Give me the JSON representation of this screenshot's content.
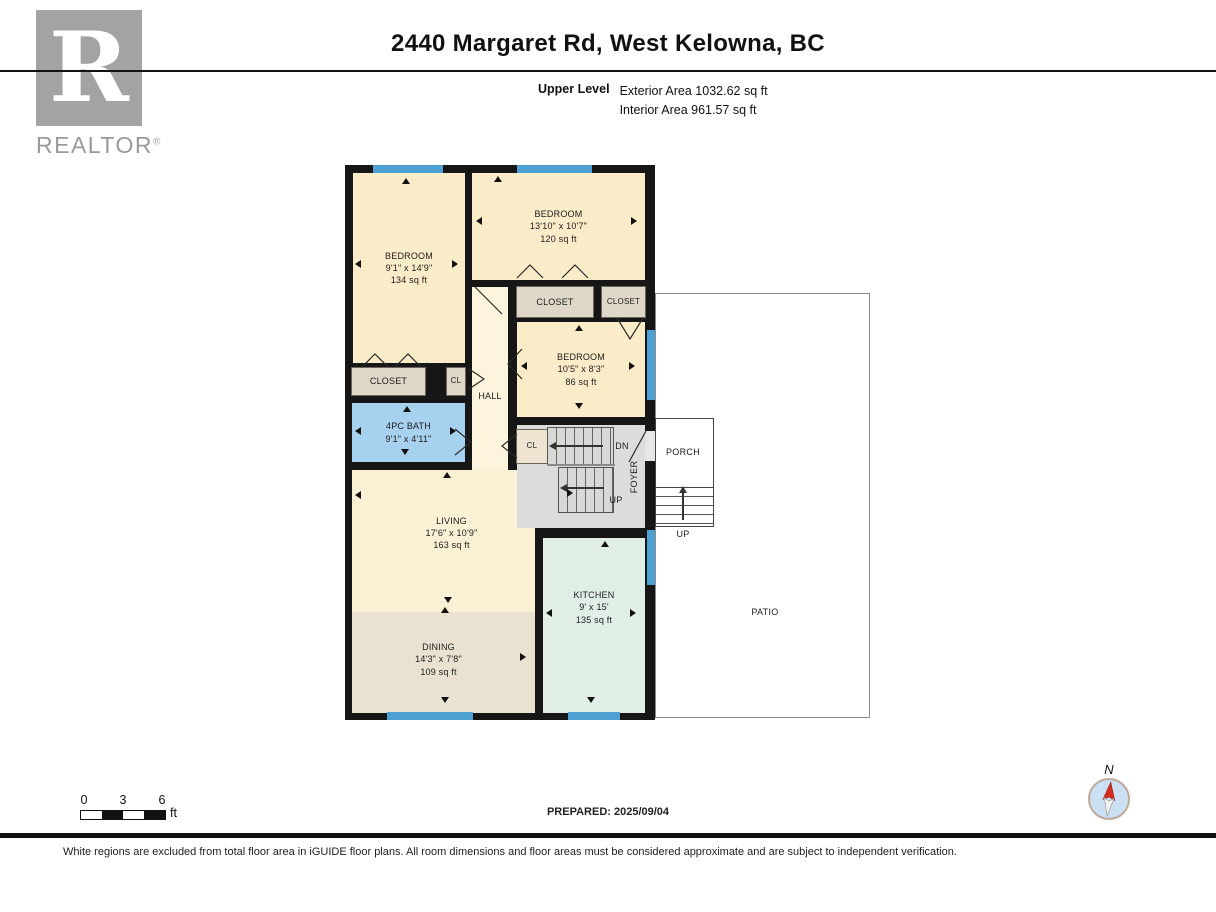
{
  "header": {
    "title": "2440 Margaret Rd, West Kelowna, BC",
    "level_label": "Upper Level",
    "exterior_area": "Exterior Area 1032.62 sq ft",
    "interior_area": "Interior Area 961.57 sq ft"
  },
  "logo": {
    "letter": "R",
    "brand": "REALTOR",
    "reg": "®"
  },
  "rooms": {
    "bedroom1": {
      "name": "BEDROOM",
      "dims": "9'1\" x 14'9\"",
      "area": "134 sq ft"
    },
    "bedroom2": {
      "name": "BEDROOM",
      "dims": "13'10\" x 10'7\"",
      "area": "120 sq ft"
    },
    "bedroom3": {
      "name": "BEDROOM",
      "dims": "10'5\" x 8'3\"",
      "area": "86 sq ft"
    },
    "bath": {
      "name": "4PC BATH",
      "dims": "9'1\" x 4'11\""
    },
    "living": {
      "name": "LIVING",
      "dims": "17'6\" x 10'9\"",
      "area": "163 sq ft"
    },
    "dining": {
      "name": "DINING",
      "dims": "14'3\" x 7'8\"",
      "area": "109 sq ft"
    },
    "kitchen": {
      "name": "KITCHEN",
      "dims": "9' x 15'",
      "area": "135 sq ft"
    },
    "closet_bed1": {
      "name": "CLOSET"
    },
    "cl_bed1": {
      "name": "CL"
    },
    "closet_bed2": {
      "name": "CLOSET"
    },
    "closet_bed3": {
      "name": "CLOSET"
    },
    "cl_foyer": {
      "name": "CL"
    },
    "hall": {
      "name": "HALL"
    },
    "foyer": {
      "name": "FOYER"
    },
    "porch": {
      "name": "PORCH"
    },
    "patio": {
      "name": "PATIO"
    }
  },
  "stairs": {
    "dn": "DN",
    "up": "UP",
    "porch_up": "UP"
  },
  "scale_bar": {
    "tick_0": "0",
    "tick_3": "3",
    "tick_6": "6",
    "unit": "ft"
  },
  "compass": {
    "north_label": "N"
  },
  "footer": {
    "prepared": "PREPARED: 2025/09/04",
    "disclaimer": "White regions are excluded from total floor area in iGUIDE floor plans. All room dimensions and floor areas must be considered approximate and are subject to independent verification."
  },
  "colors": {
    "wall": "#161616",
    "bedroom_fill": "#FAECC8",
    "living_fill": "#FAF0D4",
    "hall_fill": "#FCF4DC",
    "dining_fill": "#E9E2D1",
    "kitchen_fill": "#E0EEE5",
    "bath_fill": "#A6D2EF",
    "closet_fill": "#DFD8C9",
    "foyer_fill": "#DCDCDA",
    "window_blue": "#4E9FD2",
    "compass_red": "#D62B1F"
  },
  "plan": {
    "windows": [
      {
        "x": 28,
        "y": 0,
        "w": 70,
        "h": 8
      },
      {
        "x": 172,
        "y": 0,
        "w": 75,
        "h": 8
      },
      {
        "x": 302,
        "y": 165,
        "w": 8,
        "h": 70
      },
      {
        "x": 302,
        "y": 365,
        "w": 8,
        "h": 55
      },
      {
        "x": 42,
        "y": 547,
        "w": 86,
        "h": 8
      },
      {
        "x": 223,
        "y": 547,
        "w": 52,
        "h": 8
      }
    ],
    "arrows": [
      {
        "d": "up",
        "x": 57,
        "y": 13
      },
      {
        "d": "left",
        "x": 10,
        "y": 95
      },
      {
        "d": "right",
        "x": 107,
        "y": 95
      },
      {
        "d": "up",
        "x": 149,
        "y": 11
      },
      {
        "d": "left",
        "x": 131,
        "y": 52
      },
      {
        "d": "right",
        "x": 286,
        "y": 52
      },
      {
        "d": "up",
        "x": 230,
        "y": 160
      },
      {
        "d": "down",
        "x": 230,
        "y": 238
      },
      {
        "d": "left",
        "x": 176,
        "y": 197
      },
      {
        "d": "right",
        "x": 284,
        "y": 197
      },
      {
        "d": "left",
        "x": 10,
        "y": 262
      },
      {
        "d": "up",
        "x": 58,
        "y": 241
      },
      {
        "d": "down",
        "x": 56,
        "y": 284
      },
      {
        "d": "right",
        "x": 105,
        "y": 262
      },
      {
        "d": "up",
        "x": 98,
        "y": 307
      },
      {
        "d": "left",
        "x": 10,
        "y": 326
      },
      {
        "d": "down",
        "x": 99,
        "y": 432
      },
      {
        "d": "up",
        "x": 96,
        "y": 442
      },
      {
        "d": "right",
        "x": 175,
        "y": 488
      },
      {
        "d": "down",
        "x": 96,
        "y": 532
      },
      {
        "d": "up",
        "x": 256,
        "y": 376
      },
      {
        "d": "left",
        "x": 201,
        "y": 444
      },
      {
        "d": "right",
        "x": 285,
        "y": 444
      },
      {
        "d": "down",
        "x": 242,
        "y": 532
      },
      {
        "d": "right",
        "x": 222,
        "y": 324
      }
    ],
    "door_paths": [
      "M172,113 L185,100 L198,113",
      "M217,113 L230,100 L243,113",
      "M272,153 L285,174 L298,153",
      "M17,202 L30,189 L43,202",
      "M50,202 L63,189 L76,202",
      "M110,264 L126,277 L110,290",
      "M124,204 L139,214 L124,224",
      "M172,269 L157,281 L172,293",
      "M177,184 L163,199 L177,214",
      "M130,122 L157,149",
      "M301,266 L284,297"
    ]
  }
}
